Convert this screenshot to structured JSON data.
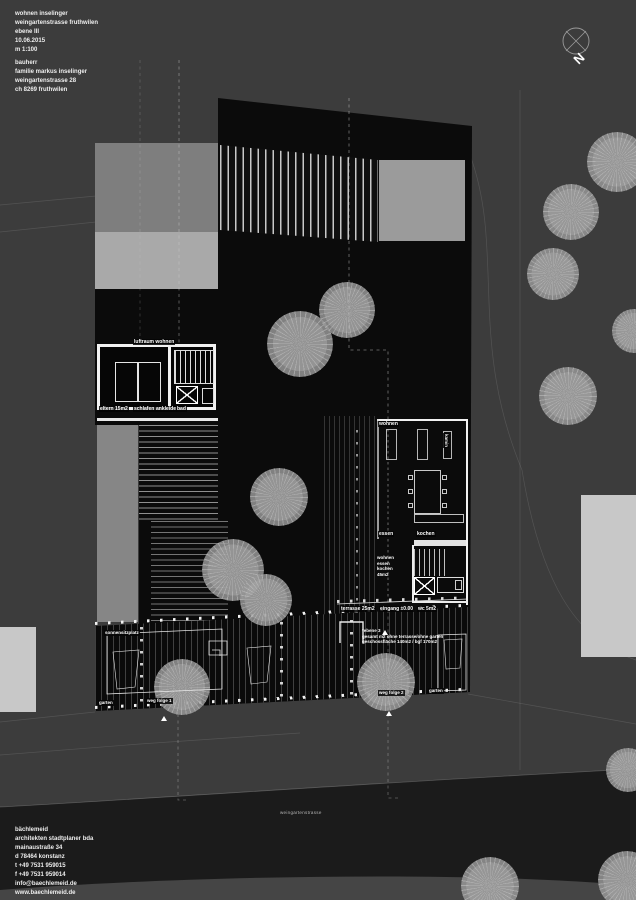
{
  "title_block": {
    "lines": [
      "wohnen inselinger",
      "weingartenstrasse fruthwilen",
      "ebene III",
      "10.06.2015",
      "m 1:100"
    ]
  },
  "client_block": {
    "heading": "bauherr",
    "lines": [
      "familie markus inselinger",
      "weingartenstrasse 28",
      "ch 8269 fruthwilen"
    ]
  },
  "firm_block": {
    "lines": [
      "bächlemeid",
      "architekten stadtplaner bda",
      "mainaustraße 34",
      "d 78464 konstanz",
      "t +49 7531 959015",
      "f +49 7531 959014",
      "info@baechlemeid.de",
      "www.baechlemeid.de"
    ]
  },
  "compass": {
    "label": "N"
  },
  "street": {
    "label": "weingartenstrasse"
  },
  "plan_labels": {
    "luftraum_wohnen": "luftraum wohnen",
    "eltern": "eltern 15m2",
    "schlafen": "schlafen",
    "ankleide": "ankleide",
    "bad": "bad",
    "wohnen": "wohnen",
    "kamin": "kamin",
    "essen": "essen",
    "kochen": "kochen",
    "area_stack": [
      "wohnen",
      "essen",
      "kochen",
      "45m2"
    ],
    "terrasse": "terrasse 25m2",
    "eingang": "eingang ±0.00",
    "wc": "wc 5m2",
    "sitzplatz": "sonnensitzplatz",
    "garten_left": "garten",
    "weg_folge_1": "weg folge 1",
    "weg_folge_2": "weg folge 2",
    "garten_right": "garten",
    "note": [
      "*ebene 3",
      "gesamt m2 ohne terrasse/ohne garten",
      "geschossfläche 140m2 / bgf 170m2"
    ]
  },
  "colors": {
    "background": "#3c3c3c",
    "building": "#0b0b0b",
    "road": "#1b1b1b",
    "roof_gray": "#9b9b9b",
    "neighbor_light": "#c8c8c8",
    "tree": "#9e9e9e",
    "wall": "#ffffff"
  }
}
